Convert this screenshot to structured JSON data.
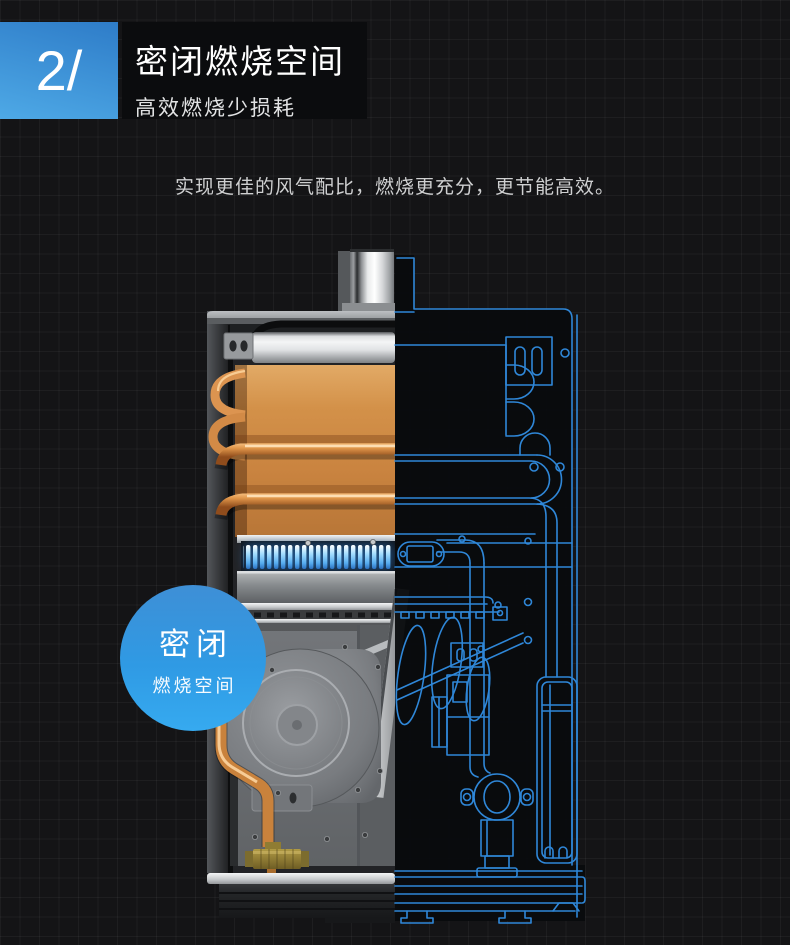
{
  "theme": {
    "page-bg": "#141416",
    "panel-bg": "#0b0c0e",
    "accent-start": "#2e7cc8",
    "accent-end": "#4ea9e6",
    "badge-start": "#3e8fd6",
    "badge-end": "#36aaf0",
    "blueprint": "#2f87d8",
    "flame": "#8ed0f8",
    "copper": "#d1914f"
  },
  "header": {
    "index_number": "2/",
    "title": "密闭燃烧空间",
    "subtitle": "高效燃烧少损耗"
  },
  "description": "实现更佳的风气配比，燃烧更充分，更节能高效。",
  "badge": {
    "title": "密闭",
    "subtitle": "燃烧空间"
  }
}
